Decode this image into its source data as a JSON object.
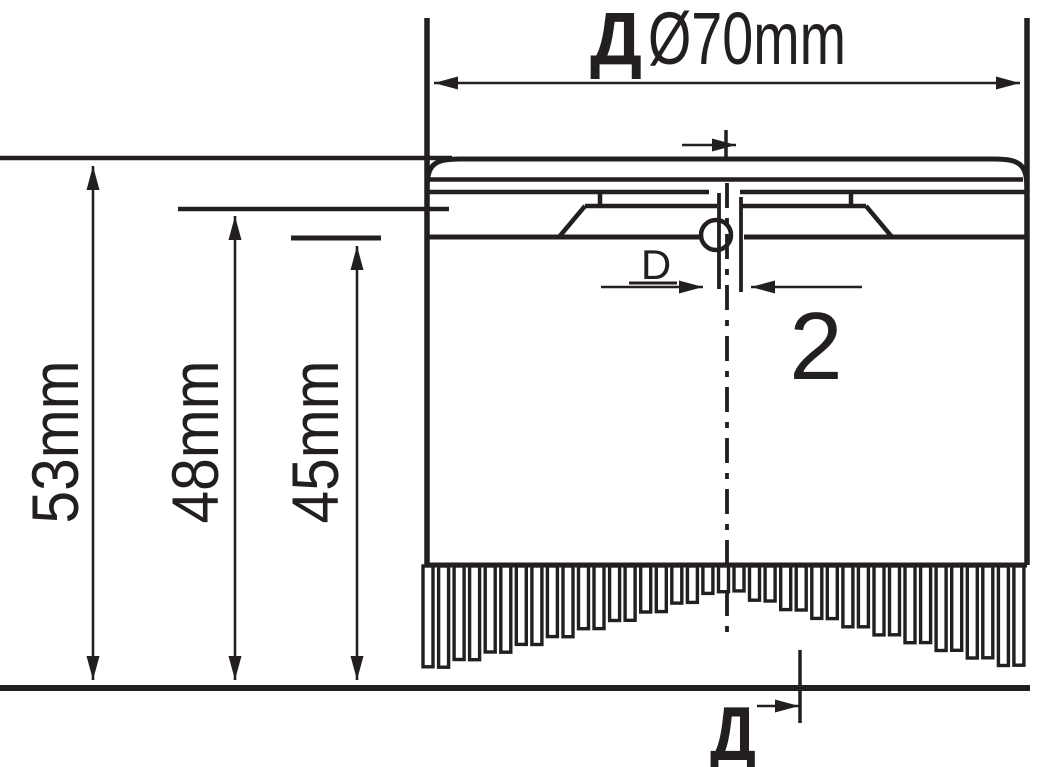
{
  "drawing": {
    "type": "technical-drawing",
    "subject": "round brush head with dimensions",
    "top_dimension": {
      "prefix": "Д",
      "value": "Ø70mm",
      "full": "ДØ70mm",
      "diameter_mm": 70
    },
    "heights": [
      {
        "label": "53mm",
        "value_mm": 53
      },
      {
        "label": "48mm",
        "value_mm": 48
      },
      {
        "label": "45mm",
        "value_mm": 45
      }
    ],
    "slot": {
      "label": "D"
    },
    "detail": {
      "label": "2"
    },
    "bottom_ref": {
      "label": "Д"
    },
    "colors": {
      "ink": "#231f20",
      "paper": "#ffffff"
    }
  },
  "figure": {
    "bristles": {
      "count": 39,
      "start_x": 423,
      "pitch": 15.55,
      "width": 10,
      "top_y": 566,
      "min_len": 20,
      "max_len": 102,
      "exponent": 0.87,
      "alt_extra": 4,
      "center_x": 727,
      "half_span": 304
    }
  }
}
